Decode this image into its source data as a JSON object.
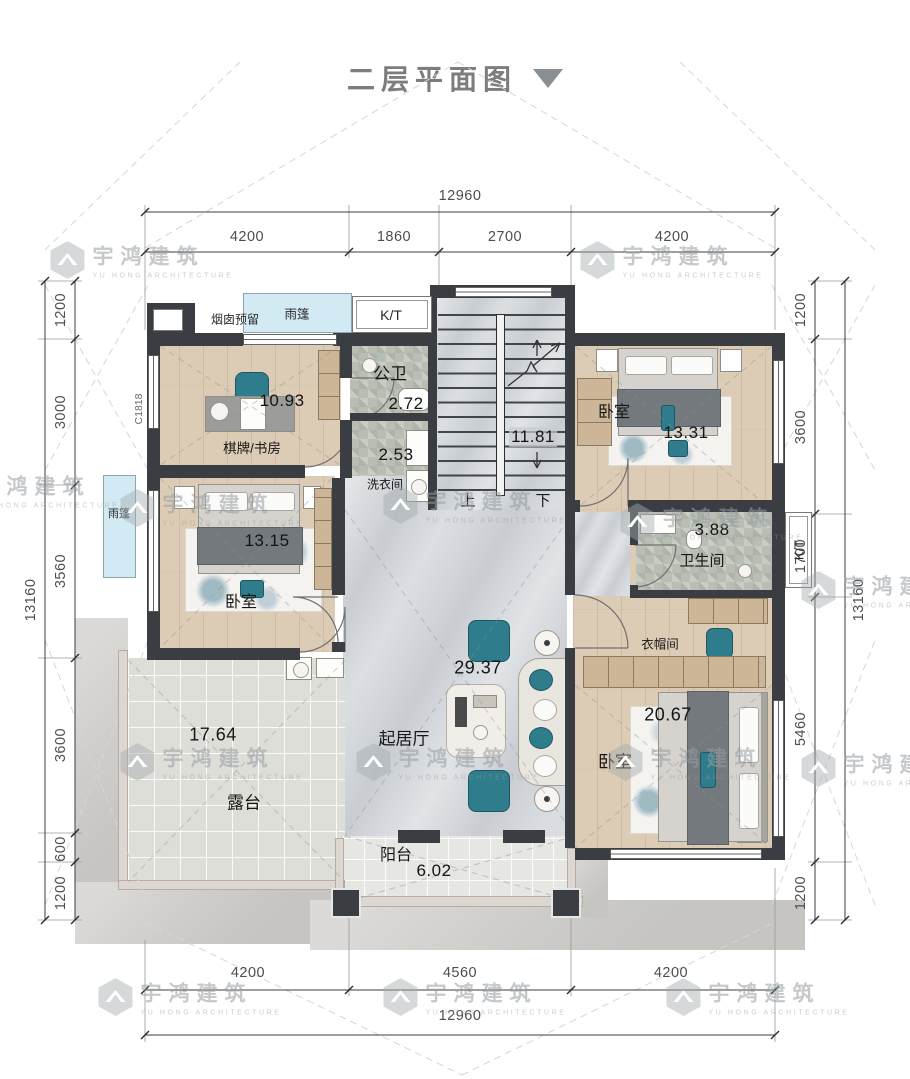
{
  "title": {
    "text": "二层平面图"
  },
  "brand": {
    "name": "宇鸿建筑",
    "sub": "YU HONG ARCHITECTURE"
  },
  "dims": {
    "top_total": "12960",
    "top_segs": [
      "4200",
      "1860",
      "2700",
      "4200"
    ],
    "bottom_segs": [
      "4200",
      "4560",
      "4200"
    ],
    "bottom_total": "12960",
    "left_total": "13160",
    "left_segs": [
      "1200",
      "3000",
      "3560",
      "3600",
      "600",
      "1200"
    ],
    "right_segs": [
      "1200",
      "3600",
      "1700",
      "5460",
      "1200"
    ],
    "right_total": "13160"
  },
  "rooms": {
    "study": {
      "name": "棋牌/书房",
      "area": "10.93"
    },
    "public_bath": {
      "name": "公卫",
      "area": "2.72"
    },
    "laundry": {
      "name": "洗衣间",
      "area": "2.53"
    },
    "stairs": {
      "area": "11.81",
      "up": "上",
      "down": "下"
    },
    "bedroom_ne": {
      "name": "卧室",
      "area": "13.31"
    },
    "bedroom_w": {
      "name": "卧室",
      "area": "13.15"
    },
    "bathroom": {
      "name": "卫生间",
      "area": "3.88"
    },
    "cloakroom": {
      "name": "衣帽间"
    },
    "living": {
      "name": "起居厅",
      "area": "29.37"
    },
    "bedroom_se": {
      "name": "卧室",
      "area": "20.67"
    },
    "terrace": {
      "name": "露台",
      "area": "17.64"
    },
    "balcony": {
      "name": "阳台",
      "area": "6.02"
    }
  },
  "labels": {
    "chimney": "烟囱预留",
    "canopy": "雨篷",
    "kt": "K/T",
    "window_code": "C1818"
  },
  "colors": {
    "wall": "#3a3e43",
    "wood_floor": "#ddccb5",
    "marble_floor": "#c9cdd2",
    "tile_floor": "#b9beb4",
    "terrace_floor": "#deded9",
    "canopy_blue": "#d2eaf4",
    "teal_accent": "#2f7d8c",
    "watermark_gray": "#a9adb1",
    "dim_text": "#4e4e4e"
  }
}
